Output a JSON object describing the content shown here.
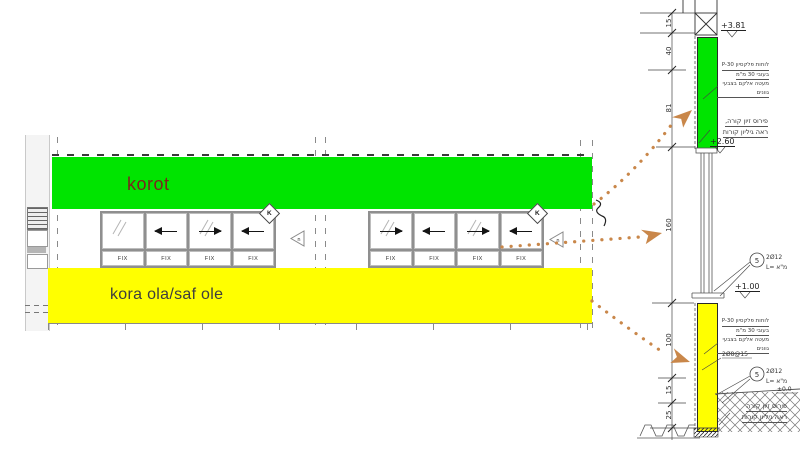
{
  "elevation": {
    "beam_label": "korot",
    "sill_label": "kora ola/saf ole",
    "fix_label": "FIX",
    "window_tag_letter": "K",
    "direction_tag_letter": "n"
  },
  "section": {
    "levels": {
      "top": "+3.81",
      "beam_bottom": "+2.60",
      "sill": "+1.00",
      "ground": "±0.0"
    },
    "dims": [
      "15",
      "40",
      "81",
      "160",
      "100",
      "15",
      "25"
    ],
    "cladding_note": [
      "לוחות פלקסיון P-30",
      "בעובי 30 מ\"מ",
      "מעטה אלקם בצבעי גוונים"
    ],
    "beam_note_top": [
      "פירוס זיון קורה,",
      "ראה גיליון קורות"
    ],
    "beam_note_bottom": [
      "פירוס זיון קורה",
      "ראה גיליון קורות"
    ],
    "rebar_tag": {
      "number": "5",
      "bars": "2Ø12",
      "length": "L= מ\"א"
    },
    "mesh_note": "2Ø8@15"
  },
  "colors": {
    "beam_highlight": "#00e400",
    "sill_highlight": "#ffff00",
    "leader_dots": "#c9874a",
    "beam_label_text": "#7b241e"
  }
}
